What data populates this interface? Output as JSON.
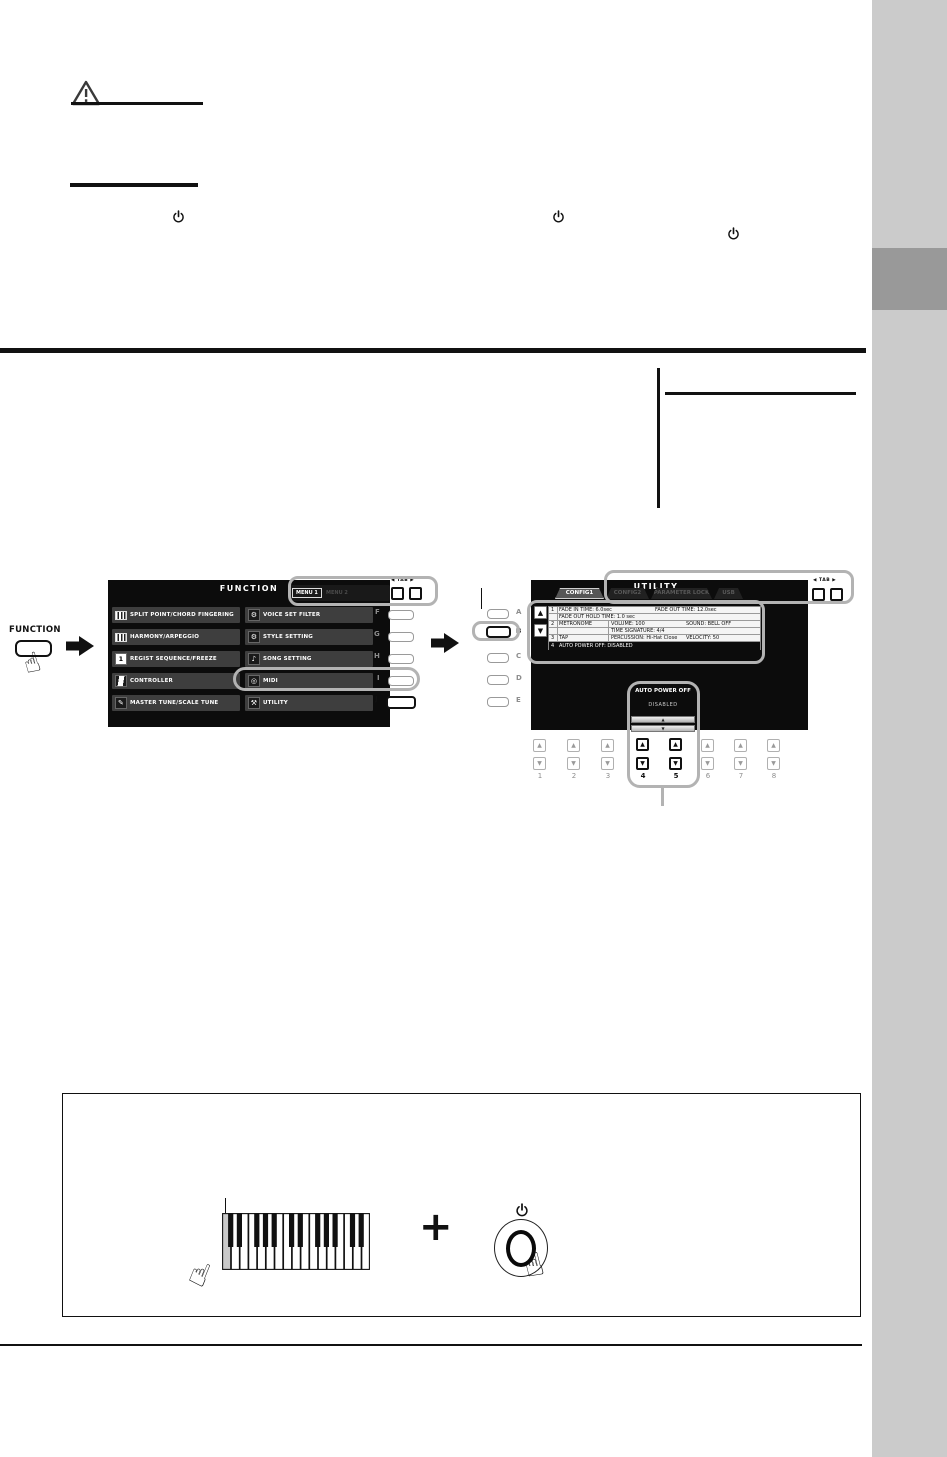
{
  "panel": {
    "function_button": {
      "label": "FUNCTION"
    },
    "display_buttons_left": [
      "A",
      "B",
      "C",
      "D",
      "E"
    ],
    "display_buttons_right": [
      "F",
      "G",
      "H",
      "I",
      "J"
    ],
    "number_buttons": [
      "1",
      "2",
      "3",
      "4",
      "5",
      "6",
      "7",
      "8"
    ],
    "tab_nav_label": "◀ TAB ▶"
  },
  "screen_function": {
    "title": "FUNCTION",
    "tabs": [
      {
        "label": "MENU 1",
        "active": true
      },
      {
        "label": "MENU 2",
        "active": false
      }
    ],
    "menu_left": [
      {
        "label": "SPLIT POINT/CHORD FINGERING"
      },
      {
        "label": "HARMONY/ARPEGGIO"
      },
      {
        "label": "REGIST SEQUENCE/FREEZE"
      },
      {
        "label": "CONTROLLER"
      },
      {
        "label": "MASTER TUNE/SCALE TUNE"
      }
    ],
    "menu_right": [
      {
        "label": "VOICE SET FILTER",
        "letter": "F"
      },
      {
        "label": "STYLE SETTING",
        "letter": "G"
      },
      {
        "label": "SONG SETTING",
        "letter": "H"
      },
      {
        "label": "MIDI",
        "letter": "I"
      },
      {
        "label": "UTILITY",
        "letter": "J"
      }
    ]
  },
  "screen_utility": {
    "title": "UTILITY",
    "tabs": [
      "CONFIG1",
      "CONFIG2",
      "PARAMETER LOCK",
      "USB"
    ],
    "list": {
      "row1": {
        "num": "1",
        "fade_in": "FADE IN TIME: 6.0sec",
        "fade_out": "FADE OUT TIME: 12.0sec",
        "fade_hold": "FADE OUT HOLD TIME: 1.0 sec"
      },
      "row2": {
        "num": "2",
        "name": "METRONOME",
        "volume": "VOLUME: 100",
        "sound": "SOUND: BELL OFF",
        "time_sig": "TIME SIGNATURE: 4/4"
      },
      "row3": {
        "num": "3",
        "name": "TAP",
        "percussion": "PERCUSSION: Hi-Hat Close",
        "velocity": "VELOCITY: 50"
      },
      "row4": {
        "num": "4",
        "text": "AUTO POWER OFF: DISABLED"
      }
    },
    "popup": {
      "title": "AUTO POWER OFF",
      "value": "DISABLED"
    }
  },
  "bottom_box": {
    "plus": "+"
  },
  "icons": {
    "hand": "☝",
    "up": "▲",
    "down": "▼",
    "regist_badge": "1",
    "gear": "⚙",
    "note": "♪",
    "midi": "◎",
    "wrench": "⚒",
    "fork": "✎"
  },
  "colors": {
    "sidebar": "#cbcbcb",
    "sidebar_tab": "#999999",
    "lcd_background": "#0c0c0c",
    "menu_row": "#3e3e3e",
    "callout": "#b3b3b3"
  }
}
